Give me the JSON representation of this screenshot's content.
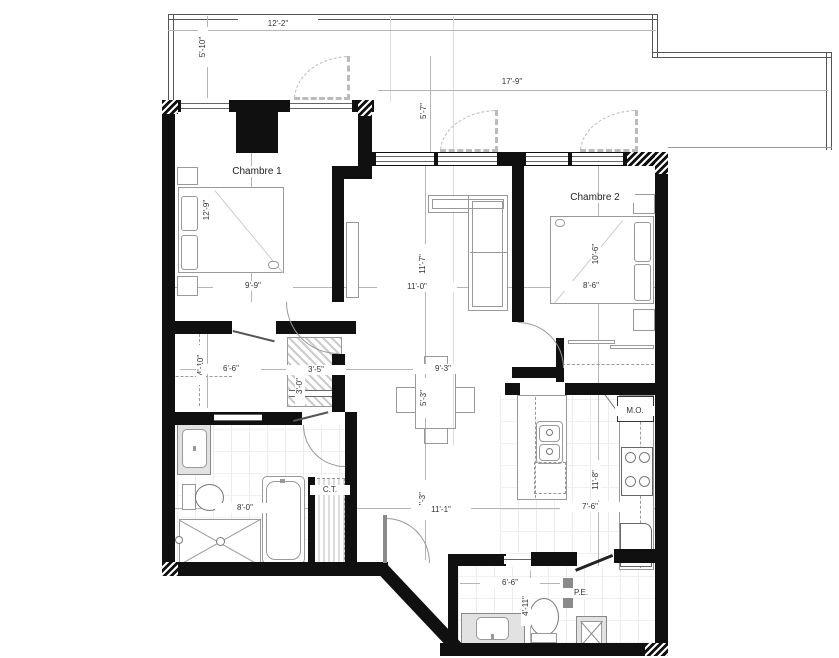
{
  "plan": {
    "balcony1": {
      "width": "12'-2\"",
      "height": "5'-10\""
    },
    "balcony2": {
      "width": "17'-9\"",
      "height": "5'-7\""
    },
    "chambre1": {
      "label": "Chambre 1",
      "width": "9'-9\"",
      "depth": "12'-9\""
    },
    "chambre2": {
      "label": "Chambre 2",
      "width": "8'-6\"",
      "depth": "10'-6\""
    },
    "living": {
      "width": "11'-0\"",
      "depth": "11'-7\""
    },
    "dining": {
      "width": "9'-3\"",
      "depth": "5'-3\""
    },
    "walkin": {
      "width": "6'-6\"",
      "depth": "4'-10\""
    },
    "closet": {
      "width": "3'-5\"",
      "depth": "3'-0\""
    },
    "bathroom": {
      "width": "8'-0\""
    },
    "ct": {
      "label": "C.T."
    },
    "hall": {
      "width": "11'-1\"",
      "depth": "7'-3\""
    },
    "kitchen": {
      "width": "7'-6\"",
      "depth": "11'-8\"",
      "microwave": "M.O."
    },
    "powder": {
      "width": "6'-6\"",
      "depth": "4'-11\""
    },
    "entry_closet": {
      "label": "P.E."
    }
  }
}
